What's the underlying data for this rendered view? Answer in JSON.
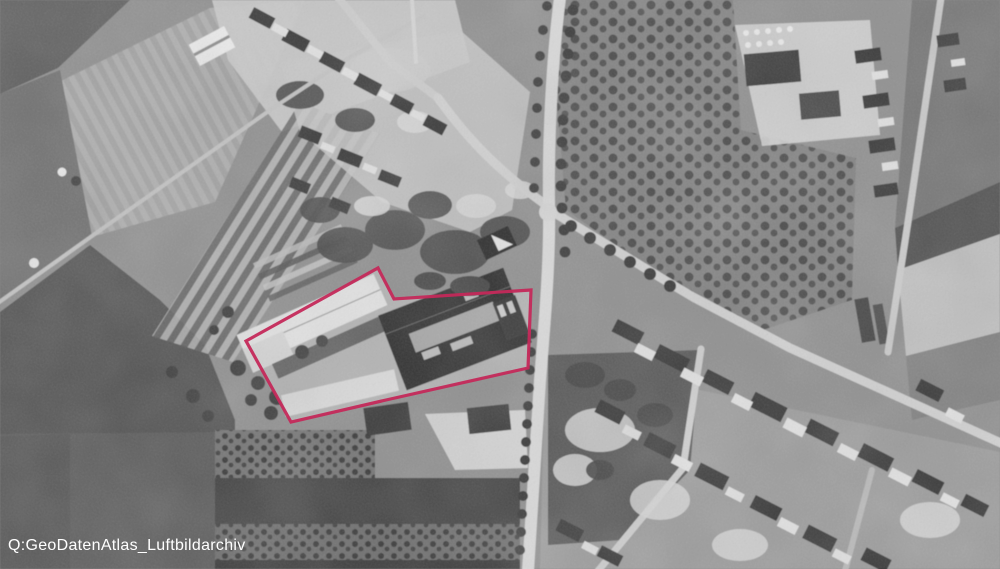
{
  "caption": {
    "text": "Q:GeoDatenAtlas_Luftbildarchiv",
    "color": "#ffffff"
  },
  "annotation": {
    "kind": "site-boundary-outline",
    "polygon_points": "246,341 378,268 394,299 531,290 528,368 386,400 291,422",
    "stroke_color": "#c4295a",
    "stroke_width_px": 3.2
  },
  "photo": {
    "style": "black-and-white historical aerial photograph",
    "highlighted_feature": "factory site with large white-roofed hall and dark industrial building, outlined in red"
  }
}
